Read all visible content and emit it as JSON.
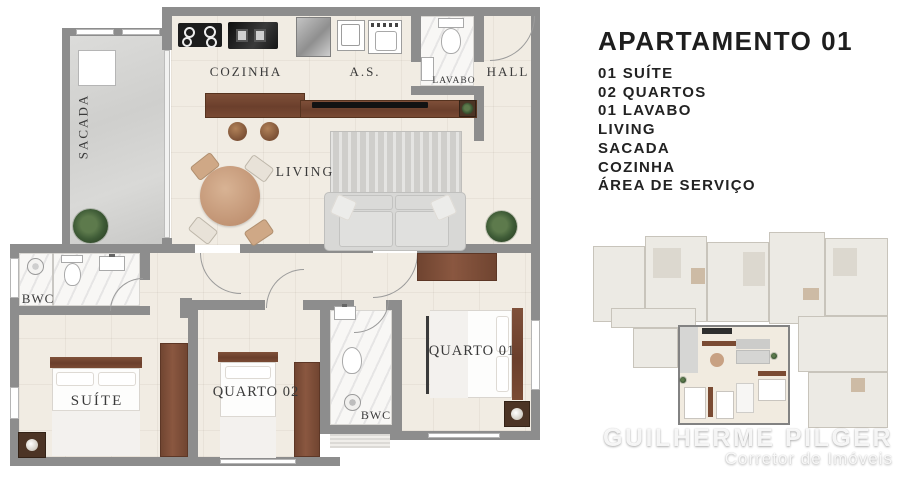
{
  "info_panel": {
    "title": "APARTAMENTO 01",
    "features": [
      "01 SUÍTE",
      "02 QUARTOS",
      "01 LAVABO",
      "LIVING",
      "SACADA",
      "COZINHA",
      "ÁREA DE SERVIÇO"
    ]
  },
  "floor_plan": {
    "labels": {
      "sacada": "SACADA",
      "cozinha": "COZINHA",
      "area_servico": "A.S.",
      "lavabo": "LAVABO",
      "hall": "HALL",
      "living": "LIVING",
      "bwc_suite": "BWC",
      "suite": "SUÍTE",
      "quarto02": "QUARTO 02",
      "bwc_social": "BWC",
      "quarto01": "QUARTO 01"
    }
  },
  "watermark": {
    "name": "GUILHERME PILGER",
    "subtitle": "Corretor de Imóveis"
  },
  "colors": {
    "wall": "#8d8d8d",
    "floor": "#f1ece3",
    "wood_dark": "#6f4430",
    "wood_light": "#c9a184",
    "plant_green": "#3f5c37",
    "text_dark": "#1e1e1e"
  }
}
